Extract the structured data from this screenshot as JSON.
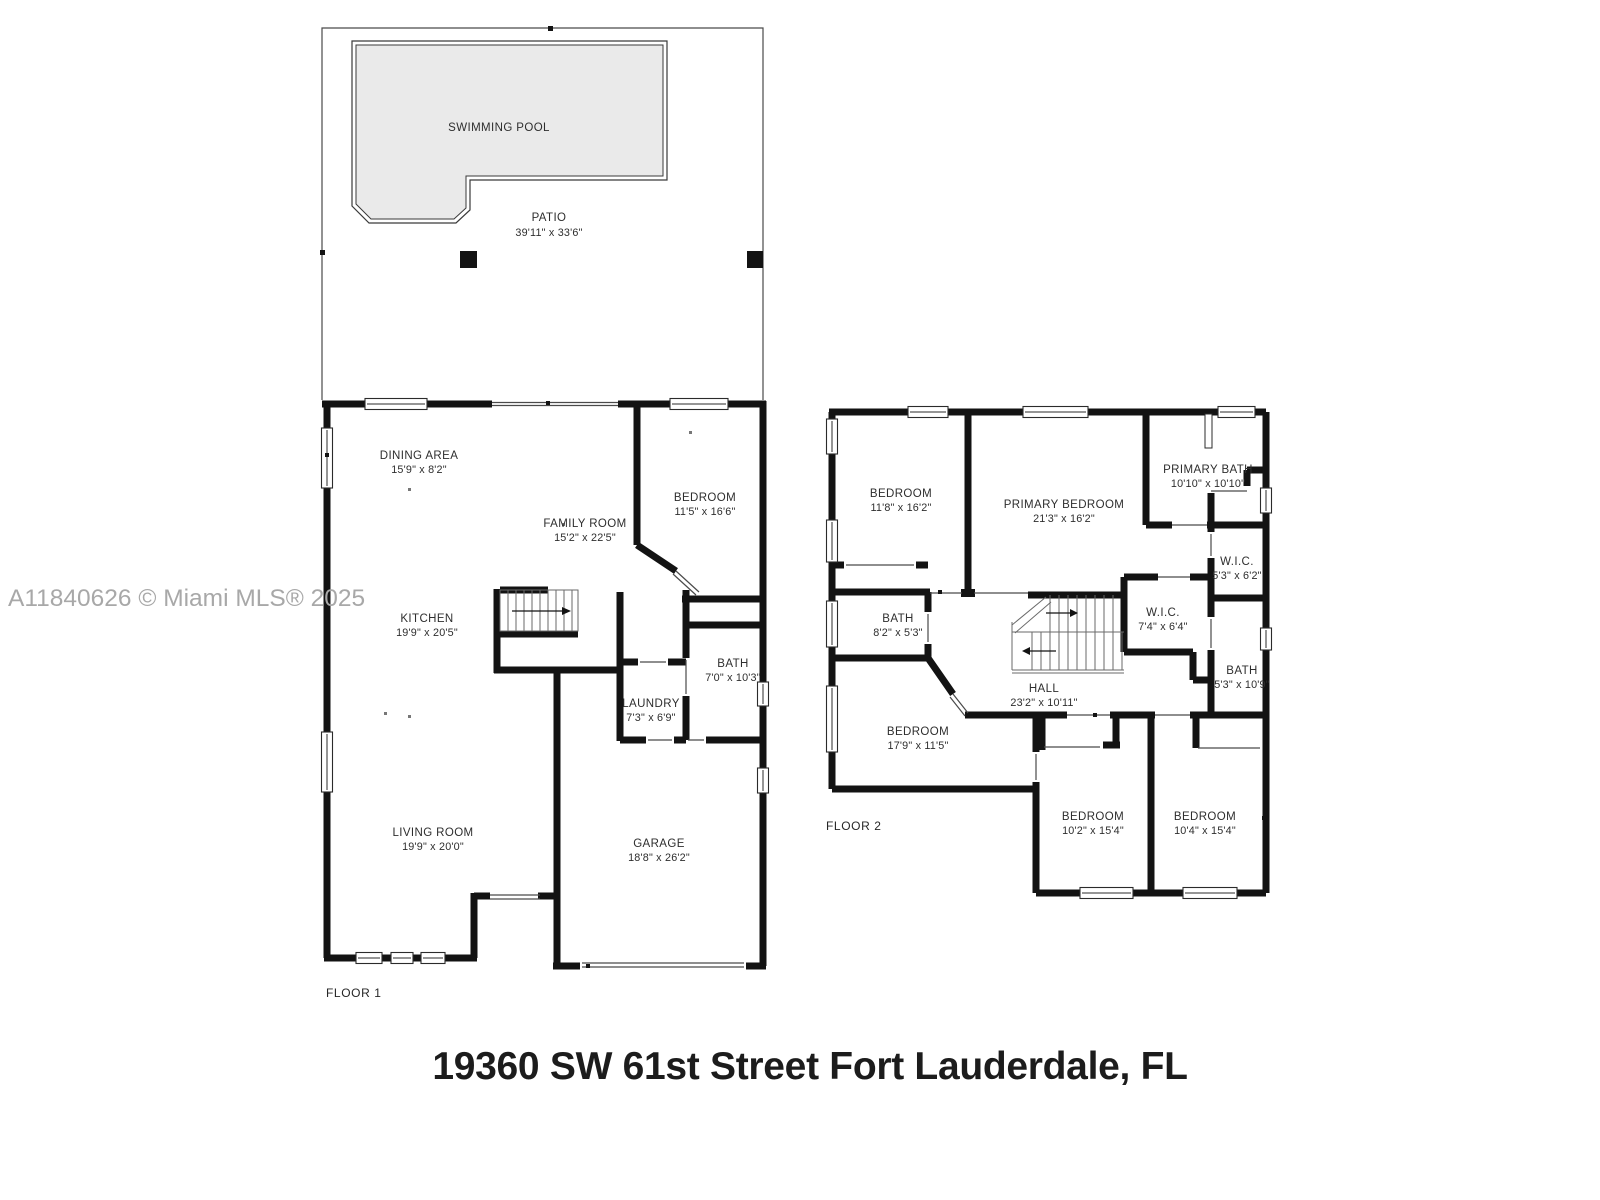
{
  "page": {
    "watermark": "A11840626 © Miami MLS® 2025",
    "address_title": "19360 SW 61st Street Fort Lauderdale, FL"
  },
  "floor1": {
    "label": "FLOOR 1",
    "outdoor": {
      "pool_label": "SWIMMING POOL",
      "patio": {
        "name": "PATIO",
        "dims": "39'11\" x 33'6\""
      }
    },
    "rooms": {
      "dining": {
        "name": "DINING AREA",
        "dims": "15'9\" x 8'2\""
      },
      "family": {
        "name": "FAMILY ROOM",
        "dims": "15'2\" x 22'5\""
      },
      "bedroom": {
        "name": "BEDROOM",
        "dims": "11'5\" x 16'6\""
      },
      "kitchen": {
        "name": "KITCHEN",
        "dims": "19'9\" x 20'5\""
      },
      "bath": {
        "name": "BATH",
        "dims": "7'0\" x 10'3\""
      },
      "laundry": {
        "name": "LAUNDRY",
        "dims": "7'3\" x 6'9\""
      },
      "living": {
        "name": "LIVING ROOM",
        "dims": "19'9\" x 20'0\""
      },
      "garage": {
        "name": "GARAGE",
        "dims": "18'8\" x 26'2\""
      }
    }
  },
  "floor2": {
    "label": "FLOOR 2",
    "rooms": {
      "bedroom2": {
        "name": "BEDROOM",
        "dims": "11'8\" x 16'2\""
      },
      "primary_bedroom": {
        "name": "PRIMARY BEDROOM",
        "dims": "21'3\" x 16'2\""
      },
      "primary_bath": {
        "name": "PRIMARY BATH",
        "dims": "10'10\" x 10'10\""
      },
      "wic_small": {
        "name": "W.I.C.",
        "dims": "5'3\" x 6'2\""
      },
      "bath_small": {
        "name": "BATH",
        "dims": "8'2\" x 5'3\""
      },
      "wic_large": {
        "name": "W.I.C.",
        "dims": "7'4\" x 6'4\""
      },
      "hall": {
        "name": "HALL",
        "dims": "23'2\" x 10'11\""
      },
      "bath_right": {
        "name": "BATH",
        "dims": "5'3\" x 10'9\""
      },
      "bedroom3": {
        "name": "BEDROOM",
        "dims": "17'9\" x 11'5\""
      },
      "bedroom4": {
        "name": "BEDROOM",
        "dims": "10'2\" x 15'4\""
      },
      "bedroom5": {
        "name": "BEDROOM",
        "dims": "10'4\" x 15'4\""
      }
    }
  },
  "colors": {
    "wall": "#131313",
    "pool_fill": "#eaeaea",
    "watermark": "#a8a8a8",
    "label_text": "#2e2e2e",
    "background": "#ffffff"
  }
}
